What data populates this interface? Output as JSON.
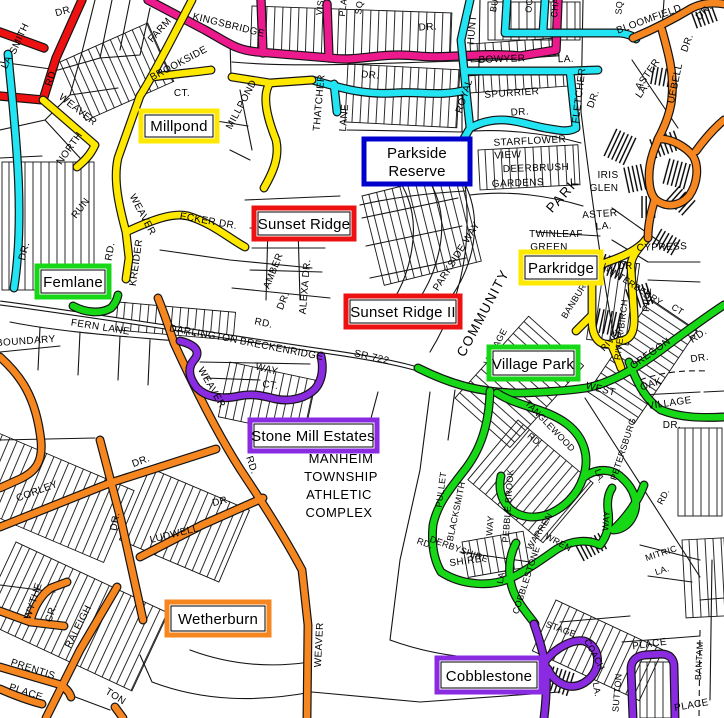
{
  "colors": {
    "pink": "#EC1A8D",
    "red": "#EE1111",
    "cyan": "#22E4F2",
    "yellow": "#FFE800",
    "green": "#16D816",
    "orange": "#F6861F",
    "purple": "#8A2BE2",
    "blue": "#0000CC",
    "road": "#141414"
  },
  "boxes": {
    "millpond": {
      "label": "Millpond",
      "color": "#FFE800"
    },
    "parkside": {
      "line1": "Parkside",
      "line2": "Reserve",
      "color": "#0000CC"
    },
    "sunset_ridge": {
      "label": "Sunset Ridge",
      "color": "#EE1111"
    },
    "sunset_ridge2": {
      "label": "Sunset Ridge II",
      "color": "#EE1111"
    },
    "femlane": {
      "label": "Femlane",
      "color": "#16D816"
    },
    "parkridge": {
      "label": "Parkridge",
      "color": "#FFE800"
    },
    "village_park": {
      "label": "Village Park",
      "color": "#16D816"
    },
    "stone_mill": {
      "label": "Stone Mill Estates",
      "color": "#8A2BE2"
    },
    "wetherburn": {
      "label": "Wetherburn",
      "color": "#F6861F"
    },
    "cobblestone": {
      "label": "Cobblestone",
      "color": "#8A2BE2"
    }
  },
  "areas": {
    "manheim1": "MANHEIM",
    "manheim2": "TOWNSHIP",
    "manheim3": "ATHLETIC",
    "manheim4": "COMPLEX",
    "community": "COMMUNITY",
    "park": "PARK"
  },
  "streets": {
    "smith": "SMITH",
    "smith_la": "LA.",
    "dr_topleft": "DR.",
    "rd_red": "RD.",
    "weaver1": "WEAVER",
    "farm": "FARM",
    "brookside": "BROOKSIDE",
    "brookside_ct": "CT.",
    "kingsbridge": "KINGSBRIDGE",
    "millpond_st": "MILLPOND",
    "north": "NORTH",
    "run": "RUN",
    "dr_cyan_left": "DR.",
    "weaver2": "WEAVER",
    "rd_weaver2": "RD.",
    "kreider": "KREIDER",
    "ecker_dr": "ECKER DR.",
    "fern_lane": "FERN LANE",
    "boundary": "BOUNDARY",
    "dr_top2": "DR.",
    "vis": "VIS",
    "pla": "PLA",
    "sq1": "SQ",
    "hunt": "HUNT",
    "bu": "BU",
    "oc": "OC",
    "cha": "CHA",
    "sq2": "SQ",
    "bloomfield": "BLOOMFIELD",
    "dr_bloom1": "DR.",
    "dr_bloom2": "DR.",
    "uebell": "UEBELL",
    "aster1": "ASTER",
    "aster1_la": "LA.",
    "thatcher": "THATCHER",
    "thatcher_lane": "LANE",
    "dr_cyan_mid": "DR.",
    "royal": "ROYAL",
    "bowyer": "BOWYER",
    "bowyer_la": "LA.",
    "spurrier": "SPURRIER",
    "spurrier_dr": "DR.",
    "fletcher": "FLETCHER",
    "fletcher_dr": "DR.",
    "starflower": "STARFLOWER",
    "view": "VIEW",
    "deerbrush": "DEERBRUSH",
    "gardens": "GARDENS",
    "iris": "IRIS",
    "glen": "GLEN",
    "twinleaf": "TWINLEAF",
    "green_lbl": "GREEN",
    "aster2": "ASTER",
    "aster2_la": "LA.",
    "parkside_way": "PARKSIDE WAY",
    "amber": "AMBER",
    "amber_dr": "DR.",
    "alexa": "ALEXA DR.",
    "rd_amber": "RD.",
    "cypress": "CYPRESS",
    "cypress_dr": "DR",
    "pike": "PIKE",
    "winterberry": "WINTERBERRY",
    "winterberry_ct": "CT",
    "river_birch": "RIVER BIRCH",
    "banbury": "BANBURY",
    "darlington": "DARLINGTON",
    "breckenridge": "BRECKENRIDGE",
    "way1": "WAY",
    "ct1": "CT.",
    "sr722": "SR 722",
    "weaver3": "WEAVER",
    "weaver3_rd": "RD.",
    "village_rd": "VILLAGE",
    "village_rd2": "RD",
    "river": "RIVER",
    "west": "WEST",
    "oregon": "OREGON",
    "oregon_rd": "RD.",
    "dr_oak_area": "DR.",
    "oak": "OAK",
    "village2": "VILLAGE",
    "village2_dr": "DR.",
    "petersburg": "PETERSBURG",
    "petersburg_rd": "RD.",
    "tanglewood": "TANGLEWOOD",
    "tanglewood_la": "LA.",
    "rd_tangle": "RD.",
    "pullet": "PULLET",
    "blacksmith": "BLACKSMITH",
    "way2": "WAY",
    "pebblebrook": "PEBBLE BROOK",
    "derbyshire_rd": "RD.",
    "derbyshire": "DERBYSHIRE",
    "warren": "WARREN",
    "cobblestone_st": "COBBLESTONE",
    "cobble_la": "LA.",
    "wren": "WREN",
    "way3": "WAY",
    "shire": "SHIRE",
    "stage": "STAGE",
    "coach": "COACH",
    "coach_la": "LA.",
    "sutton": "SUTTON",
    "place1": "PLACE",
    "mitric": "MITRIC",
    "mitric_la": "LA.",
    "bantam": "BANTAM",
    "place2": "PLACE",
    "corley": "CORLEY",
    "corley_dr": "DR.",
    "dr_vertB": "DR.",
    "ludwell": "LUDWELL",
    "ludwell_dr": "DR.",
    "wythe": "WYTHE",
    "wythe_cr": "CR.",
    "raleigh": "RALEIGH",
    "prentis": "PRENTIS",
    "place3": "PLACE",
    "ton": "TON",
    "weaver4": "WEAVER"
  }
}
